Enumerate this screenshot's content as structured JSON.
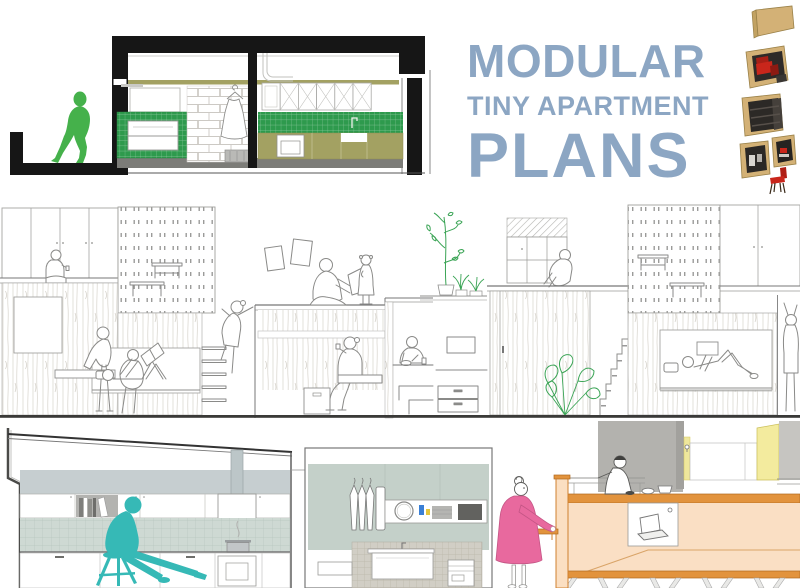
{
  "page": {
    "width": 800,
    "height": 588,
    "background": "#ffffff"
  },
  "title": {
    "line1": "MODULAR",
    "line2": "TINY APARTMENT",
    "line3": "PLANS"
  },
  "palette": {
    "title_blue": "#8ca6c3",
    "figure_green": "#45b14b",
    "tile_green": "#2e9a4d",
    "olive": "#a3a162",
    "plant_green": "#3aa455",
    "teal": "#36b9b6",
    "pink": "#e8699e",
    "pink_stroke": "#c45585",
    "orange": "#e2933d",
    "orange_stroke": "#b06a20",
    "peach": "#fadfc4",
    "tan": "#d3b176",
    "red": "#c9261b",
    "ink": "#161616",
    "line_gray": "#8a8a88",
    "wall_gray": "#b3b2ae",
    "sage": "#c4d0c9",
    "band_gray": "#c6ced0",
    "kitchen_tile": "#ced9d3",
    "vanity_tile": "#d1cec5",
    "yellow": "#f3eb9e"
  }
}
